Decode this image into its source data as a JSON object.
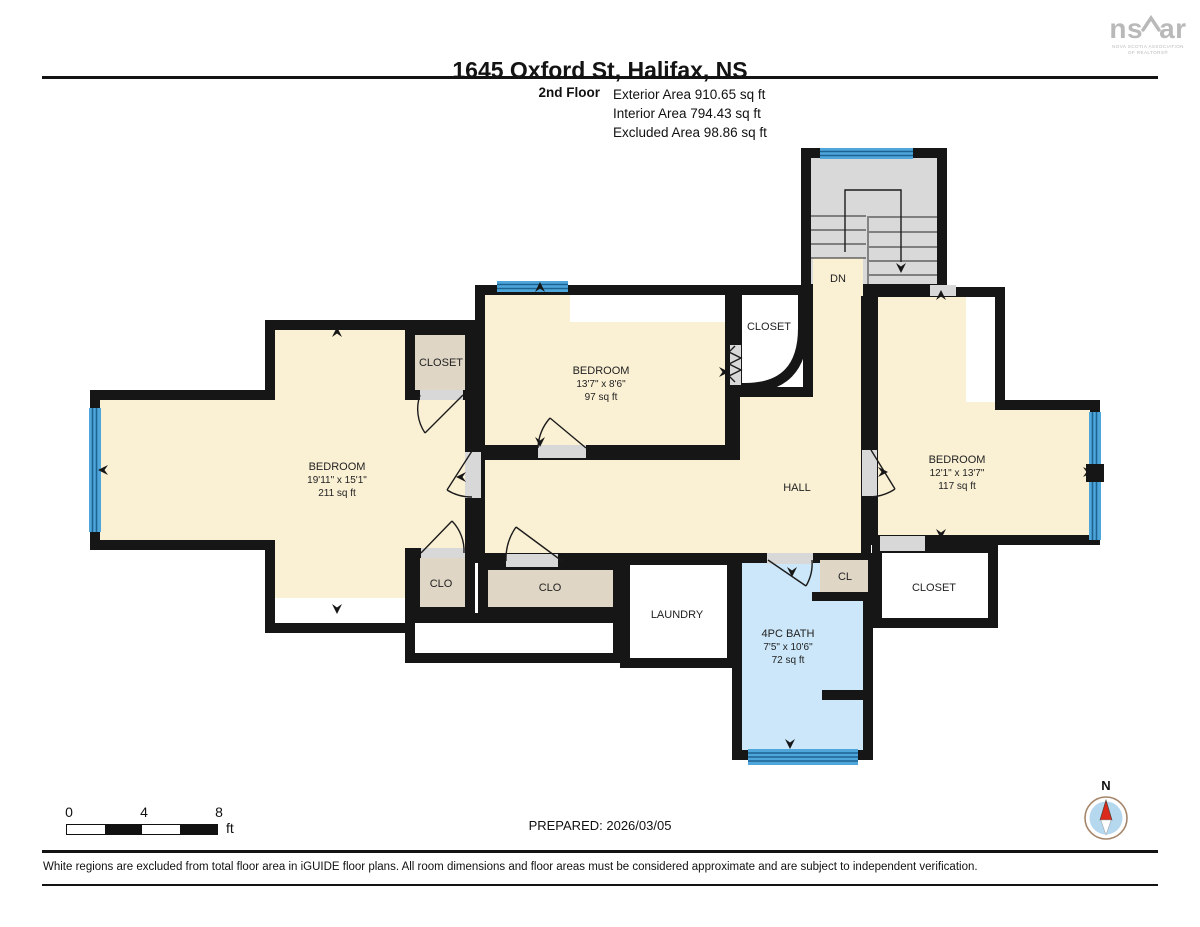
{
  "header": {
    "title": "1645 Oxford St, Halifax, NS",
    "floor_label": "2nd Floor",
    "areas": [
      "Exterior Area 910.65 sq ft",
      "Interior Area 794.43 sq ft",
      "Excluded Area 98.86 sq ft"
    ]
  },
  "logo": {
    "part1": "ns",
    "part2": "ar",
    "subline1": "NOVA SCOTIA ASSOCIATION",
    "subline2": "OF REALTORS®"
  },
  "rooms": {
    "bedroom_left": {
      "name": "BEDROOM",
      "dims": "19'11\" x 15'1\"",
      "area": "211 sq ft"
    },
    "bedroom_middle": {
      "name": "BEDROOM",
      "dims": "13'7\" x 8'6\"",
      "area": "97 sq ft"
    },
    "bedroom_right": {
      "name": "BEDROOM",
      "dims": "12'1\" x 13'7\"",
      "area": "117 sq ft"
    },
    "bath": {
      "name": "4PC BATH",
      "dims": "7'5\" x 10'6\"",
      "area": "72 sq ft"
    },
    "hall": {
      "name": "HALL"
    },
    "laundry": {
      "name": "LAUNDRY"
    },
    "closet_top_left": {
      "name": "CLOSET"
    },
    "closet_by_stairs": {
      "name": "CLOSET"
    },
    "closet_right": {
      "name": "CLOSET"
    },
    "clo_left": {
      "name": "CLO"
    },
    "clo_center": {
      "name": "CLO"
    },
    "cl": {
      "name": "CL"
    },
    "stairs": {
      "name": "DN"
    }
  },
  "footer": {
    "scale_ticks": [
      "0",
      "4",
      "8"
    ],
    "scale_unit": "ft",
    "prepared": "PREPARED: 2026/03/05",
    "compass_north": "N",
    "disclaimer": "White regions are excluded from total floor area in iGUIDE floor plans. All room dimensions and floor areas must be considered approximate and are subject to independent verification."
  },
  "colors": {
    "wall_black": "#161616",
    "room_cream": "#FAF0D4",
    "closet_tan": "#DFD6C5",
    "bath_blue": "#CBE7F9",
    "stairs_gray": "#D9D9D9",
    "window_blue": "#4FA6DA",
    "window_line": "#1D6391",
    "door_gap_gray": "#D8D8D8",
    "excluded_white": "#FFFFFF",
    "compass_red": "#DA2A1B",
    "compass_ring": "#A5866B",
    "compass_blue": "#B5D8EF",
    "logo_gray": "#B9B9B9"
  }
}
